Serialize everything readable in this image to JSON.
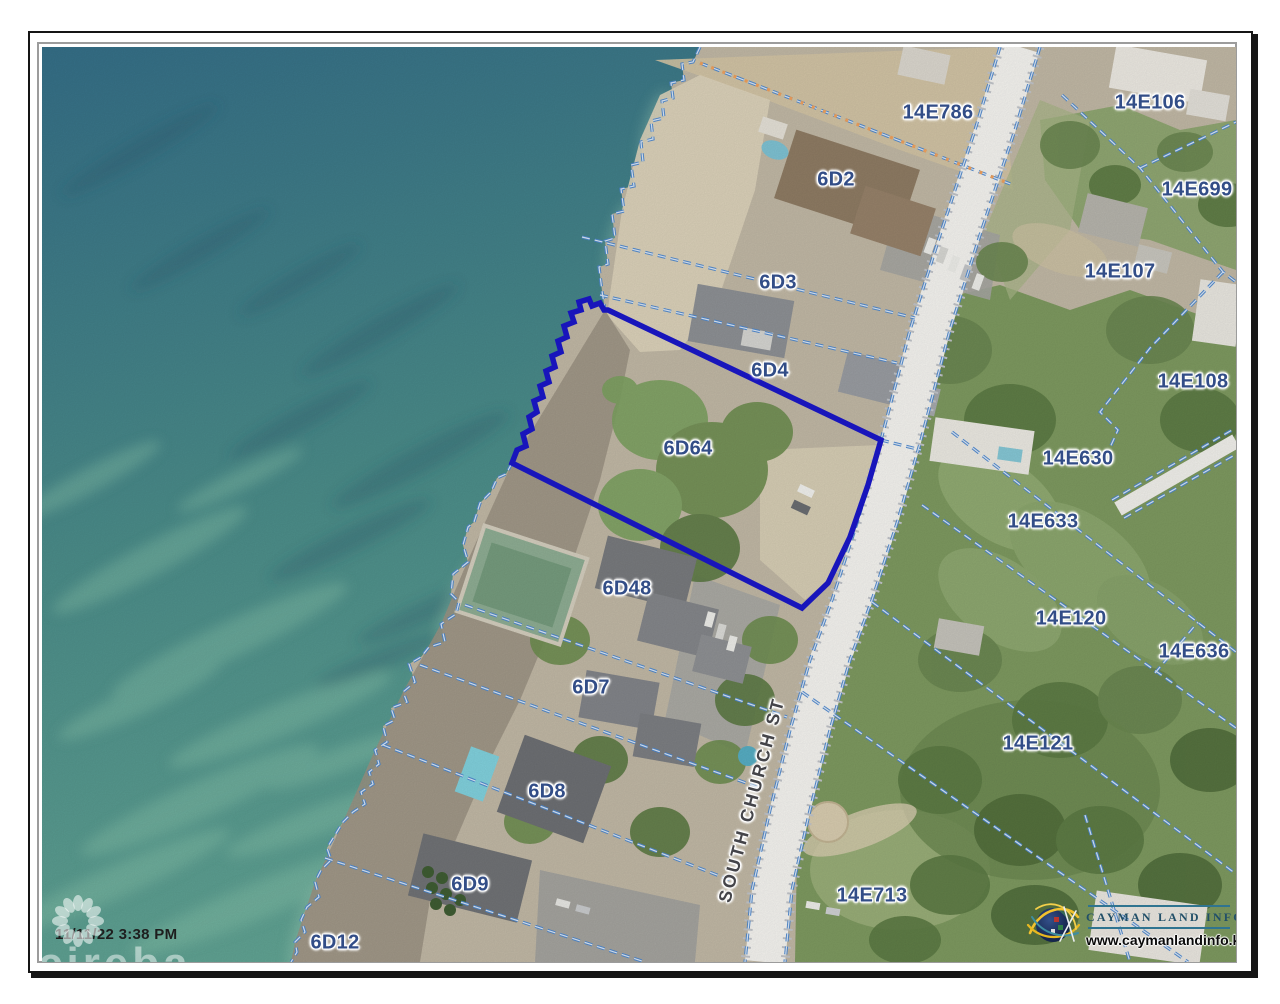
{
  "map": {
    "timestamp": "11/11/22 3:38 PM",
    "watermark": "cireba",
    "selected_parcel": "6D64",
    "parcel_labels": [
      {
        "text": "14E786",
        "x": 938,
        "y": 113
      },
      {
        "text": "6D2",
        "x": 836,
        "y": 180
      },
      {
        "text": "14E106",
        "x": 1150,
        "y": 103
      },
      {
        "text": "14E699",
        "x": 1197,
        "y": 190
      },
      {
        "text": "6D3",
        "x": 778,
        "y": 283
      },
      {
        "text": "14E107",
        "x": 1120,
        "y": 272
      },
      {
        "text": "6D4",
        "x": 770,
        "y": 371
      },
      {
        "text": "14E108",
        "x": 1193,
        "y": 382
      },
      {
        "text": "6D64",
        "x": 688,
        "y": 449
      },
      {
        "text": "14E630",
        "x": 1078,
        "y": 459
      },
      {
        "text": "14E633",
        "x": 1043,
        "y": 522
      },
      {
        "text": "6D48",
        "x": 627,
        "y": 589
      },
      {
        "text": "14E120",
        "x": 1071,
        "y": 619
      },
      {
        "text": "14E636",
        "x": 1194,
        "y": 652
      },
      {
        "text": "6D7",
        "x": 591,
        "y": 688
      },
      {
        "text": "14E121",
        "x": 1038,
        "y": 744
      },
      {
        "text": "6D8",
        "x": 547,
        "y": 792
      },
      {
        "text": "6D9",
        "x": 470,
        "y": 885
      },
      {
        "text": "14E713",
        "x": 872,
        "y": 896
      },
      {
        "text": "6D12",
        "x": 335,
        "y": 943
      }
    ],
    "road_label": {
      "text": "SOUTH CHURCH ST",
      "x": 752,
      "y": 800,
      "rotation": -75
    }
  },
  "logo": {
    "name": "CAYMAN LAND INFO",
    "url": "www.caymanlandinfo.ky"
  },
  "colors": {
    "parcel_line": "#4d88cf",
    "selected_parcel_outline": "#1a17c9",
    "label_text": "#324d87",
    "ocean_deep": "#356f88",
    "ocean_shallow": "#64a795"
  }
}
